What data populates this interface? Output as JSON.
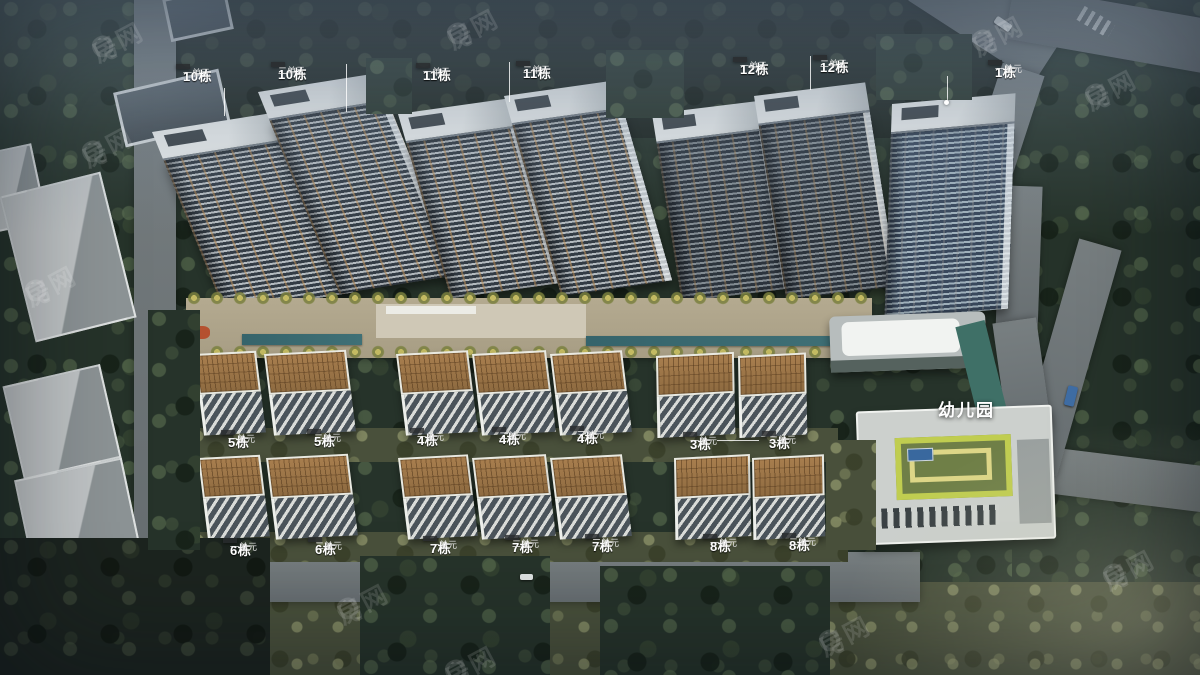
{
  "kindergarten": {
    "label": "幼儿园"
  },
  "watermark": {
    "text": "房网",
    "logo_glyph": "Q",
    "color": "rgba(255,255,255,0.13)",
    "positions": [
      {
        "x": 85,
        "y": 38
      },
      {
        "x": 75,
        "y": 143
      },
      {
        "x": 18,
        "y": 282
      },
      {
        "x": 440,
        "y": 25
      },
      {
        "x": 965,
        "y": 32
      },
      {
        "x": 1078,
        "y": 86
      },
      {
        "x": 330,
        "y": 600
      },
      {
        "x": 812,
        "y": 632
      },
      {
        "x": 1096,
        "y": 566
      },
      {
        "x": 438,
        "y": 662
      }
    ]
  },
  "building_labels": [
    {
      "building": "10栋",
      "unit": "一单元",
      "x": 176,
      "y": 64
    },
    {
      "building": "10栋",
      "unit": "二单元",
      "x": 271,
      "y": 62
    },
    {
      "building": "11栋",
      "unit": "一单元",
      "x": 416,
      "y": 63
    },
    {
      "building": "11栋",
      "unit": "二单元",
      "x": 516,
      "y": 61
    },
    {
      "building": "12栋",
      "unit": "一单元",
      "x": 733,
      "y": 57
    },
    {
      "building": "12栋",
      "unit": "二单元",
      "x": 813,
      "y": 55
    },
    {
      "building": "1栋",
      "unit": "一单元",
      "x": 988,
      "y": 60
    },
    {
      "building": "5栋",
      "unit": "一单元",
      "x": 221,
      "y": 430
    },
    {
      "building": "5栋",
      "unit": "二单元",
      "x": 307,
      "y": 429
    },
    {
      "building": "4栋",
      "unit": "一单元",
      "x": 410,
      "y": 428
    },
    {
      "building": "4栋",
      "unit": "二单元",
      "x": 492,
      "y": 427
    },
    {
      "building": "4栋",
      "unit": "三单元",
      "x": 570,
      "y": 426
    },
    {
      "building": "3栋",
      "unit": "一单元",
      "x": 683,
      "y": 432
    },
    {
      "building": "3栋",
      "unit": "二单元",
      "x": 762,
      "y": 431
    },
    {
      "building": "6栋",
      "unit": "一单元",
      "x": 223,
      "y": 538
    },
    {
      "building": "6栋",
      "unit": "二单元",
      "x": 308,
      "y": 537
    },
    {
      "building": "7栋",
      "unit": "一单元",
      "x": 423,
      "y": 536
    },
    {
      "building": "7栋",
      "unit": "二单元",
      "x": 505,
      "y": 535
    },
    {
      "building": "7栋",
      "unit": "三单元",
      "x": 585,
      "y": 534
    },
    {
      "building": "8栋",
      "unit": "一单元",
      "x": 703,
      "y": 534
    },
    {
      "building": "8栋",
      "unit": "二单元",
      "x": 782,
      "y": 533
    }
  ],
  "colors": {
    "label_background": "rgba(40,43,45,0.82)",
    "label_text": "#ffffff",
    "watermark": "rgba(255,255,255,0.13)",
    "pool_teal": "#3a6a70",
    "midrise_roof_tan": "#9a7450",
    "tower_accent": "#b98d57",
    "tree_dark": "#26332a",
    "road_gray": "#6e7577",
    "kindergarten_stripe_green": "#c0cd50",
    "kindergarten_stripe_yellow": "#ddd687"
  }
}
